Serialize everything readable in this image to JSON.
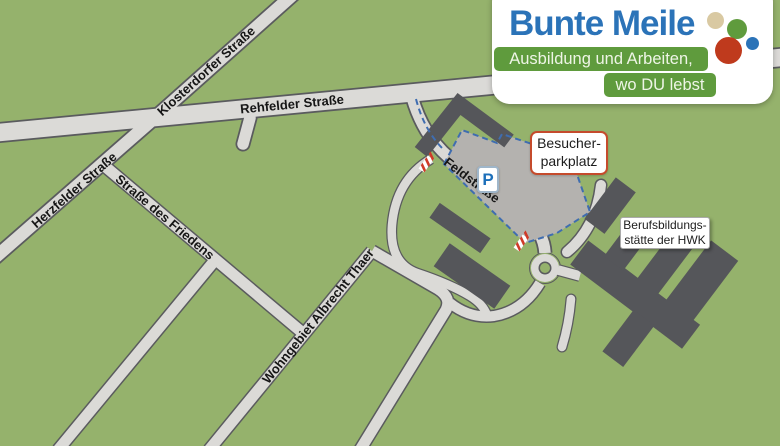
{
  "logo": {
    "title": "Bunte Meile",
    "tagline1": "Ausbildung und Arbeiten,",
    "tagline2": "wo DU lebst",
    "colors": {
      "brand_blue": "#2b73b8",
      "brand_green": "#5f9b3d",
      "brand_red": "#bf3a1d",
      "brand_tan": "#d9c9a2"
    }
  },
  "map": {
    "streets": {
      "klosterdorfer": "Klosterdorfer Straße",
      "rehfelder": "Rehfelder Straße",
      "herzfelder": "Herzfelder Straße",
      "friedens": "Straße des Friedens",
      "wohngebiet": "Wohngebiet Albrecht Thaer",
      "feldstrasse": "Feldstraße"
    },
    "labels": {
      "parking": {
        "line1": "Besucher-",
        "line2": "parkplatz"
      },
      "hwk": {
        "line1": "Berufsbildungs-",
        "line2": "stätte der HWK"
      }
    },
    "parking_icon": "P",
    "colors": {
      "map_green": "#95b26c",
      "road_fill": "#dbdad7",
      "road_casing": "#5a5b5e",
      "building_gray": "#55565a",
      "parking_gray": "#b4b2af",
      "route_blue": "#3f6db0",
      "barrier_red": "#cf3a28",
      "parking_label_border": "#c54b2c"
    }
  }
}
